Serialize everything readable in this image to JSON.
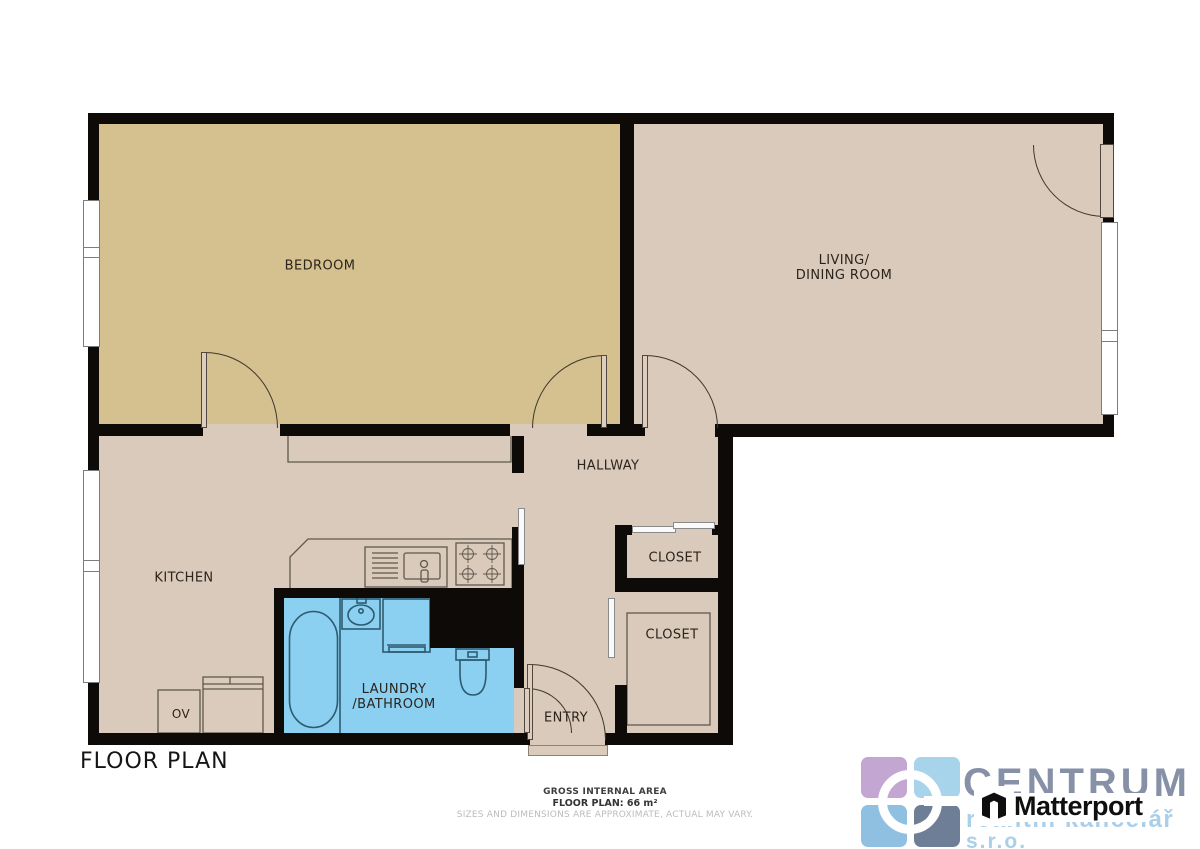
{
  "title": "FLOOR PLAN",
  "rooms": {
    "bedroom": "BEDROOM",
    "living_line1": "LIVING/",
    "living_line2": "DINING ROOM",
    "hallway": "HALLWAY",
    "kitchen": "KITCHEN",
    "closet_upper": "CLOSET",
    "closet_lower": "CLOSET",
    "laundry_line1": "LAUNDRY",
    "laundry_line2": "/BATHROOM",
    "entry": "ENTRY",
    "oven": "OV"
  },
  "footer": {
    "area_label": "GROSS INTERNAL AREA",
    "area_value": "FLOOR PLAN: 66 m²",
    "disclaimer": "SIZES AND DIMENSIONS ARE APPROXIMATE, ACTUAL MAY VARY."
  },
  "branding": {
    "company": "CENTRUM",
    "company_sub1": "realitní kancelář",
    "company_sub2": "s.r.o.",
    "matterport": "Matterport"
  },
  "colors": {
    "wall": "#0d0a07",
    "bedroom_floor": "#d5c18f",
    "main_floor": "#d9cabb",
    "bathroom_floor": "#8bcff1",
    "fixture_outline": "#5f574d",
    "bathroom_outline": "#2d5b70",
    "centrum_gray_blue": "#8691a7",
    "centrum_light_blue": "#a9cfe9",
    "matterport_black": "#0f0f0f"
  }
}
